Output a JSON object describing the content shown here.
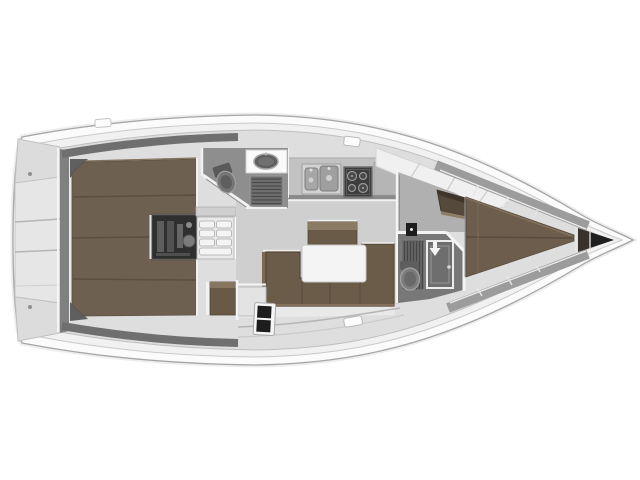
{
  "meta": {
    "type": "sailboat-interior-floor-plan",
    "orientation": "bow-right"
  },
  "colors": {
    "background": "#ffffff",
    "hull_outer": "#fbfbfb",
    "hull_stroke": "#a6a6a6",
    "deck": "#f1f1f1",
    "deck_stroke": "#c9c9c9",
    "interior": "#dedede",
    "interior_stroke": "#bfbfbf",
    "wall_dark": "#6f6f6f",
    "transom_wall": "#808080",
    "stern_panel": "#e6e6e6",
    "stern_corner_panel": "#dcdcdc",
    "berth_brown": "#6e6051",
    "berth_seam": "#5a4e41",
    "vberth_brown": "#6d5d4c",
    "settee_brown": "#6b5b49",
    "settee_edge": "#544636",
    "sideboard_brown": "#6a5a48",
    "wood_light": "#8b7a64",
    "cabinet_brown": "#695947",
    "locker_brown_dark": "#55493c",
    "table_white": "#f4f4f4",
    "engine_dark": "#2f2f2f",
    "steps_light": "#e9e9e9",
    "tread": "#f4f4f4",
    "head_floor": "#8e8e8e",
    "fwd_head_floor": "#787878",
    "fixture_gray": "#757575",
    "grate_gray": "#6f6f6f",
    "grate_line": "#4a4a4a",
    "counter_gray": "#c2c2c2",
    "sink_gray": "#a6a6a6",
    "stove_dark": "#3d3d3d",
    "burner_gray": "#9a9a9a",
    "anchor_locker": "#1f1f1f",
    "anchor_locker_left": "#3a322a",
    "shelf_gray": "#9c9c9c",
    "floor_light": "#cfcfcf",
    "floor_strip": "#e9e9e9",
    "white_trim": "#f4f4f4",
    "cleat_dark": "#1d1d1d"
  }
}
